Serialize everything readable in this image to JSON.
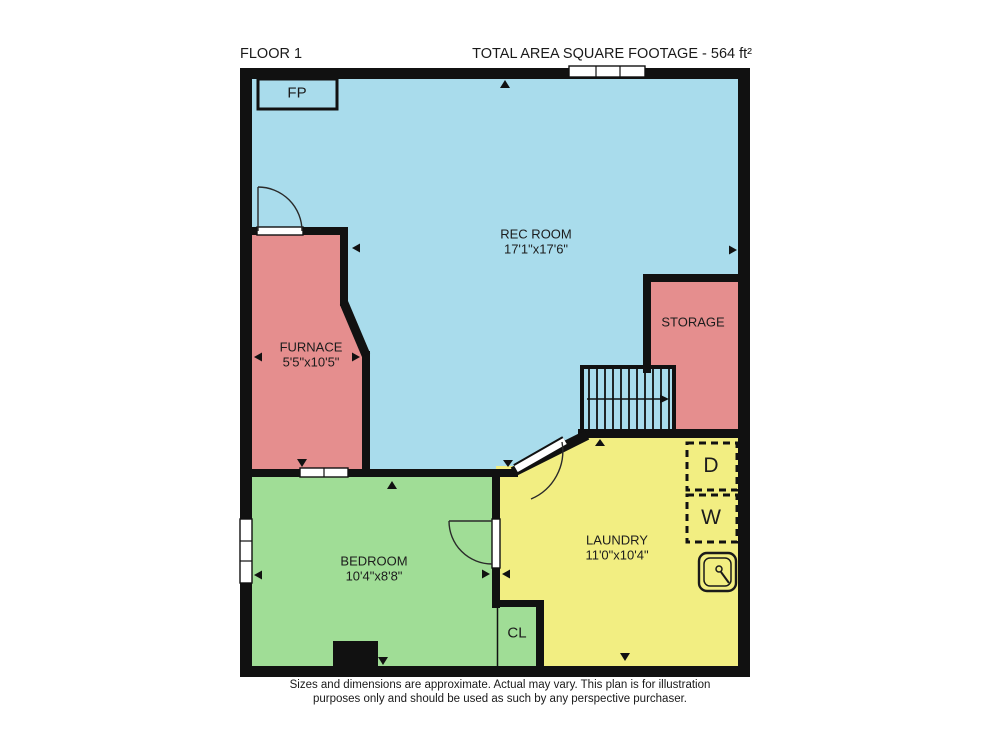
{
  "title_bar": {
    "floor_label": "FLOOR 1",
    "area_label": "TOTAL AREA SQUARE FOOTAGE - 564 ft²"
  },
  "rooms": {
    "rec_room": {
      "name": "REC ROOM",
      "dimensions": "17'1\"x17'6\"",
      "color": "#a9dcec"
    },
    "furnace": {
      "name": "FURNACE",
      "dimensions": "5'5\"x10'5\"",
      "color": "#e58e8e"
    },
    "storage": {
      "name": "STORAGE",
      "color": "#e58e8e"
    },
    "bedroom": {
      "name": "BEDROOM",
      "dimensions": "10'4\"x8'8\"",
      "color": "#a0dd96"
    },
    "laundry": {
      "name": "LAUNDRY",
      "dimensions": "11'0\"x10'4\"",
      "color": "#f2ee82"
    },
    "closet": {
      "name": "CL",
      "color": "#a0dd96"
    }
  },
  "fixtures": {
    "fireplace_label": "FP",
    "dryer_label": "D",
    "washer_label": "W"
  },
  "disclaimer": {
    "line1": "Sizes and dimensions are approximate. Actual may vary. This plan is for illustration",
    "line2": "purposes only and should be used as such by any perspective purchaser."
  },
  "colors": {
    "wall": "#111111",
    "window": "#ffffff",
    "background": "#ffffff"
  }
}
